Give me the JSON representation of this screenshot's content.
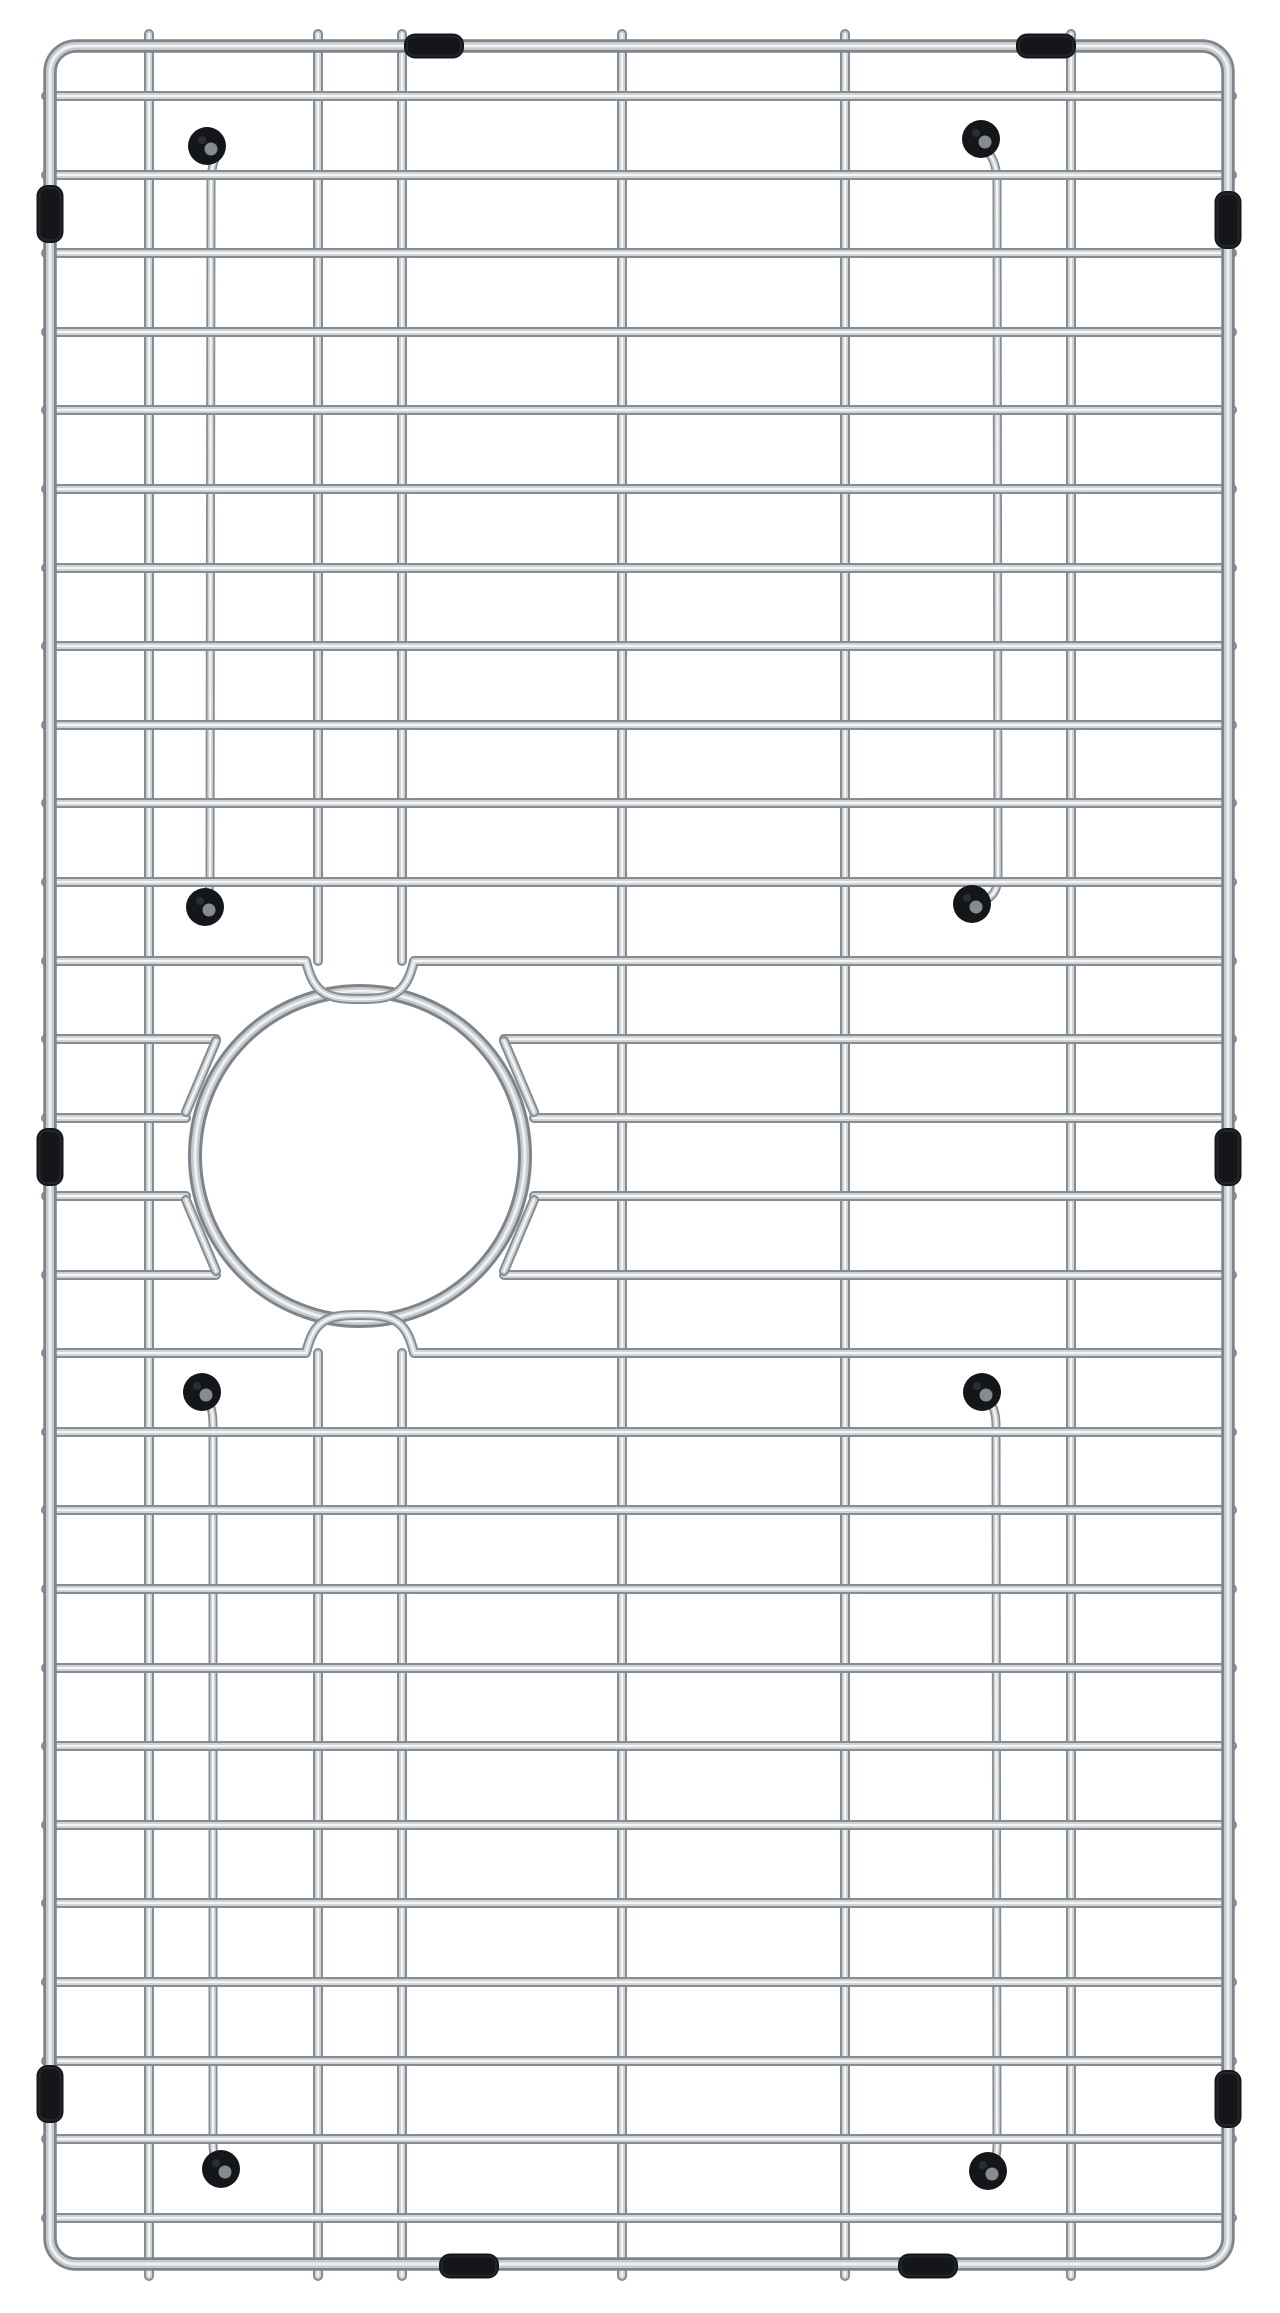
{
  "product": {
    "name": "Stainless steel kitchen sink bottom grid with round drain cutout and black rubber bumpers",
    "background_color": "#ffffff",
    "steel_edge_color": "#868c92",
    "steel_mid_color": "#ced2d5",
    "steel_highlight_color": "#f4f5f6",
    "frame_edge_color": "#7e848b",
    "frame_mid_color": "#c6cacd",
    "frame_highlight_color": "#eef0f2",
    "rubber_color": "#141619",
    "rubber_highlight_color": "#3d434a",
    "cap_hole_color": "#858b91"
  },
  "geometry": {
    "canvas": {
      "width": 1280,
      "height": 2313
    },
    "frame": {
      "x1": 50,
      "y1": 46,
      "x2": 1228,
      "y2": 2264,
      "corner_radius": 26,
      "stroke_widths": [
        13.5,
        8,
        3
      ]
    },
    "wire_stroke_widths": [
      10,
      6,
      2.2
    ],
    "foot_stroke_widths": [
      9,
      5.5,
      2
    ],
    "row_x": {
      "start": 46,
      "end": 1232
    },
    "rows": [
      {
        "y": 96,
        "type": "full"
      },
      {
        "y": 175,
        "type": "full"
      },
      {
        "y": 253,
        "type": "full"
      },
      {
        "y": 332,
        "type": "full"
      },
      {
        "y": 410,
        "type": "full"
      },
      {
        "y": 489,
        "type": "full"
      },
      {
        "y": 568,
        "type": "full"
      },
      {
        "y": 646,
        "type": "full"
      },
      {
        "y": 725,
        "type": "full"
      },
      {
        "y": 803,
        "type": "full"
      },
      {
        "y": 882,
        "type": "full"
      },
      {
        "y": 961,
        "type": "u_down"
      },
      {
        "y": 1039,
        "type": "split",
        "gap": [
          216,
          504
        ]
      },
      {
        "y": 1118,
        "type": "split",
        "gap": [
          186,
          534
        ]
      },
      {
        "y": 1196,
        "type": "split",
        "gap": [
          186,
          534
        ]
      },
      {
        "y": 1275,
        "type": "split",
        "gap": [
          216,
          504
        ]
      },
      {
        "y": 1353,
        "type": "u_up"
      },
      {
        "y": 1432,
        "type": "full"
      },
      {
        "y": 1510,
        "type": "full"
      },
      {
        "y": 1589,
        "type": "full"
      },
      {
        "y": 1668,
        "type": "full"
      },
      {
        "y": 1746,
        "type": "full"
      },
      {
        "y": 1825,
        "type": "full"
      },
      {
        "y": 1903,
        "type": "full"
      },
      {
        "y": 1982,
        "type": "full"
      },
      {
        "y": 2061,
        "type": "full"
      },
      {
        "y": 2139,
        "type": "full"
      },
      {
        "y": 2218,
        "type": "full"
      }
    ],
    "column_y": {
      "start": 34,
      "end": 2276
    },
    "columns": [
      {
        "x": 149,
        "segments": [
          [
            34,
            2276
          ]
        ]
      },
      {
        "x": 318,
        "segments": [
          [
            34,
            961
          ],
          [
            1353,
            2276
          ]
        ]
      },
      {
        "x": 402,
        "segments": [
          [
            34,
            961
          ],
          [
            1353,
            2276
          ]
        ]
      },
      {
        "x": 622,
        "segments": [
          [
            34,
            2276
          ]
        ]
      },
      {
        "x": 845,
        "segments": [
          [
            34,
            2276
          ]
        ]
      },
      {
        "x": 1071,
        "segments": [
          [
            34,
            2276
          ]
        ]
      }
    ],
    "u_loop": {
      "x1": 306,
      "x2": 414,
      "cx": 360,
      "depth": 38
    },
    "ring": {
      "cx": 360,
      "cy": 1156,
      "r": 165,
      "stroke_widths": [
        14,
        8,
        3
      ]
    },
    "connectors": [
      [
        216,
        1041,
        186,
        1112
      ],
      [
        186,
        1200,
        216,
        1271
      ],
      [
        504,
        1041,
        534,
        1112
      ],
      [
        534,
        1200,
        504,
        1271
      ]
    ],
    "feet": [
      {
        "wire": "M 219 152 C 213 160 211 170 211 186 L 210 876 C 210 890 208 897 202 903",
        "cap_top": {
          "cx": 207,
          "cy": 146
        },
        "cap_bottom": {
          "cx": 205,
          "cy": 907
        }
      },
      {
        "wire": "M 986 150 C 994 158 997 168 997 184 L 998 874 C 998 888 995 896 982 902",
        "cap_top": {
          "cx": 981,
          "cy": 139
        },
        "cap_bottom": {
          "cx": 972,
          "cy": 904
        }
      },
      {
        "wire": "M 206 1398 C 211 1404 213 1412 213 1426 L 213 2142 C 213 2154 215 2162 219 2166",
        "cap_top": {
          "cx": 202,
          "cy": 1392
        },
        "cap_bottom": {
          "cx": 221,
          "cy": 2169
        }
      },
      {
        "wire": "M 986 1398 C 993 1404 996 1412 996 1426 L 997 2146 C 997 2158 994 2164 989 2168",
        "cap_top": {
          "cx": 982,
          "cy": 1392
        },
        "cap_bottom": {
          "cx": 988,
          "cy": 2171
        }
      }
    ],
    "cap": {
      "radius": 19,
      "hole_radius": 6.5,
      "hole_offset": [
        4,
        3
      ]
    },
    "bumper_sizes": {
      "v": [
        27,
        58
      ],
      "h": [
        60,
        25
      ],
      "rx": 11
    },
    "bumpers": [
      {
        "orient": "v",
        "cx": 50,
        "cy": 214
      },
      {
        "orient": "v",
        "cx": 50,
        "cy": 1157
      },
      {
        "orient": "v",
        "cx": 50,
        "cy": 2094
      },
      {
        "orient": "v",
        "cx": 1228,
        "cy": 220
      },
      {
        "orient": "v",
        "cx": 1228,
        "cy": 1157
      },
      {
        "orient": "v",
        "cx": 1228,
        "cy": 2099
      },
      {
        "orient": "h",
        "cx": 434,
        "cy": 46
      },
      {
        "orient": "h",
        "cx": 1046,
        "cy": 46
      },
      {
        "orient": "h",
        "cx": 469,
        "cy": 2266
      },
      {
        "orient": "h",
        "cx": 928,
        "cy": 2266
      }
    ]
  }
}
